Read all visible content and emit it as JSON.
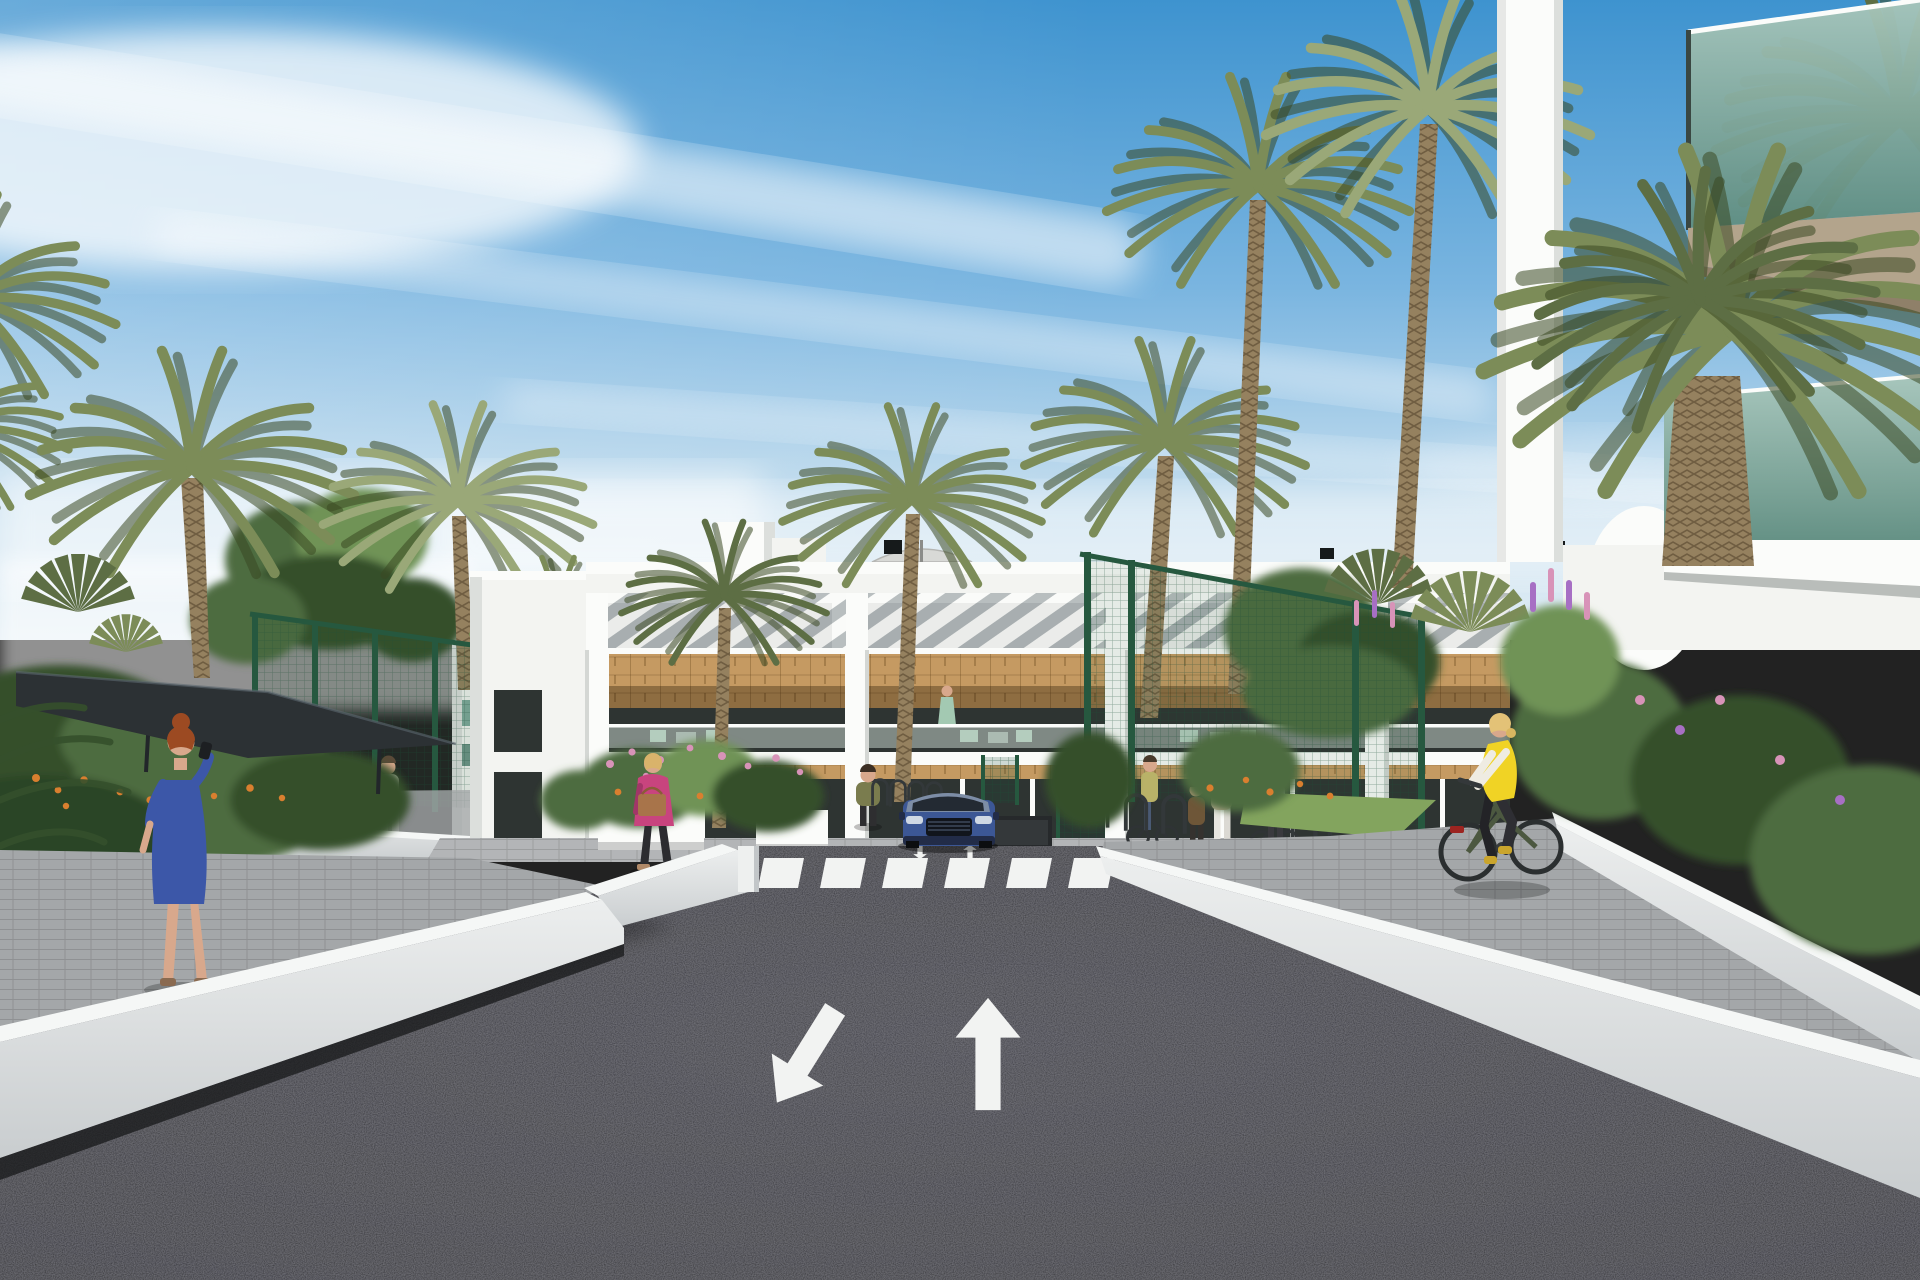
{
  "meta": {
    "type": "architectural-render",
    "setting": "modern residential complex street view with palm trees",
    "time_of_day": "daytime clear sky"
  },
  "palette": {
    "sky_top": "#3e93cf",
    "sky_mid": "#7ab5e0",
    "sky_low": "#c3ddee",
    "sky_horizon": "#e2eef5",
    "cloud": "#ffffff",
    "building_white": "#f3f4f1",
    "building_shade": "#dcdfdc",
    "parapet": "#fbfcfa",
    "stripe_shadow": "#b3b9bb",
    "window_dark": "#2e3432",
    "window_mid": "#4a524f",
    "wood": "#c59a62",
    "wood_dark": "#9c7845",
    "glass_balustrade": "#c2cfc9",
    "mint": "#a3c9b2",
    "road": "#2b2b2f",
    "road_light": "#3a3a40",
    "marking": "#f2f3f2",
    "wall_top": "#f5f7f6",
    "wall_face": "#dcdfe0",
    "wall_shade": "#b4b8ba",
    "pavement": "#a4a7a9",
    "pavement_light": "#b3b5b7",
    "fence_green": "#26583f",
    "canopy": "#2c3134",
    "palm": "#7c8c58",
    "palm_dark": "#5d6e44",
    "palm_light": "#9aa878",
    "trunk": "#95815f",
    "trunk_dark": "#6f5d41",
    "tree": "#4e6c3f",
    "tree_dark": "#35502c",
    "tree_light": "#6f9356",
    "grass": "#83a45e",
    "flower_orange": "#d97f2f",
    "flower_pink": "#d893b8",
    "flower_purple": "#a76fc4",
    "car_blue": "#3c5795",
    "car_dark": "#222c48",
    "skin": "#d8a88c",
    "glass_green_hi": "#a8c6ba",
    "glass_green_lo": "#5f8d80",
    "soffit_tan": "#b3a48c",
    "dress_blue": "#3c57a8",
    "jacket_pink": "#c8447e",
    "vest_yellow": "#f0d325",
    "hair_red": "#9c4a22",
    "hair_blonde": "#d9b36b"
  },
  "scene": {
    "road_markings": [
      "zebra-crosswalk",
      "straight-ahead-arrow",
      "down-left-arrow",
      "small-lane-arrows"
    ],
    "vehicles": [
      "blue-suv-front"
    ],
    "people": [
      "woman-blue-dress-phone",
      "man-white-shirt",
      "woman-pink-jacket-handbag",
      "person-aqua-top",
      "woman-olive-jacket",
      "woman-on-bicycle",
      "child",
      "woman-floral-blouse",
      "woman-gray-with-bike",
      "cyclist-yellow-vest",
      "balcony-figure-mint-dress",
      "balcony-figure-right",
      "person-behind-fence"
    ],
    "structures": [
      "main-apartment-building",
      "right-foreground-building",
      "white-ramp-walls",
      "green-mesh-fences",
      "shade-canopy",
      "planters",
      "bike-racks",
      "garage-opening",
      "roof-umbrellas",
      "roof-ac-units"
    ],
    "vegetation": [
      "date-palms",
      "fan-palms",
      "deciduous-trees",
      "flowering-bushes-orange",
      "flowering-bushes-pink",
      "flower-spikes-purple",
      "grass-patch"
    ]
  }
}
